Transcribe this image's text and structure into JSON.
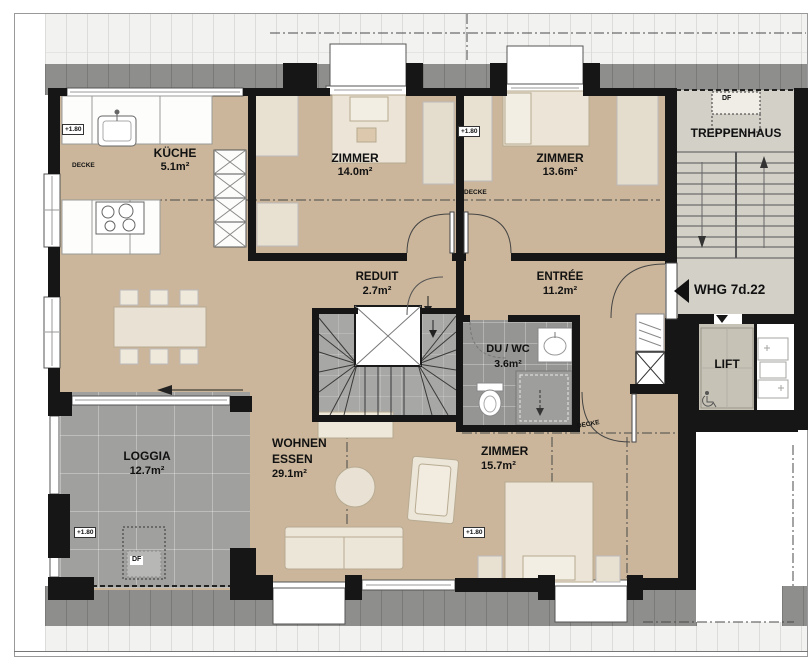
{
  "plan": {
    "rooms": {
      "kueche": {
        "name": "KÜCHE",
        "area": "5.1m²"
      },
      "zimmer_nw": {
        "name": "ZIMMER",
        "area": "14.0m²"
      },
      "zimmer_ne": {
        "name": "ZIMMER",
        "area": "13.6m²"
      },
      "reduit": {
        "name": "REDUIT",
        "area": "2.7m²"
      },
      "entree": {
        "name": "ENTRÉE",
        "area": "11.2m²"
      },
      "duwc": {
        "name": "DU / WC",
        "area": "3.6m²"
      },
      "zimmer_s": {
        "name": "ZIMMER",
        "area": "15.7m²"
      },
      "wohnen_essen": {
        "line1": "WOHNEN",
        "line2": "ESSEN",
        "area": "29.1m²"
      },
      "loggia": {
        "name": "LOGGIA",
        "area": "12.7m²"
      },
      "treppenhaus": {
        "name": "TREPPENHAUS"
      },
      "lift": {
        "name": "LIFT"
      }
    },
    "labels": {
      "apartment_id": "WHG 7d.22",
      "ceiling": "DECKE",
      "roof_window": "DF",
      "level": "+1.80"
    },
    "colors": {
      "wall": "#161616",
      "wood_floor": "#cbb69b",
      "tile_gray": "#a0a09e",
      "roof_dark": "#8e8e8c",
      "roof_light": "#f2f2f1"
    }
  }
}
